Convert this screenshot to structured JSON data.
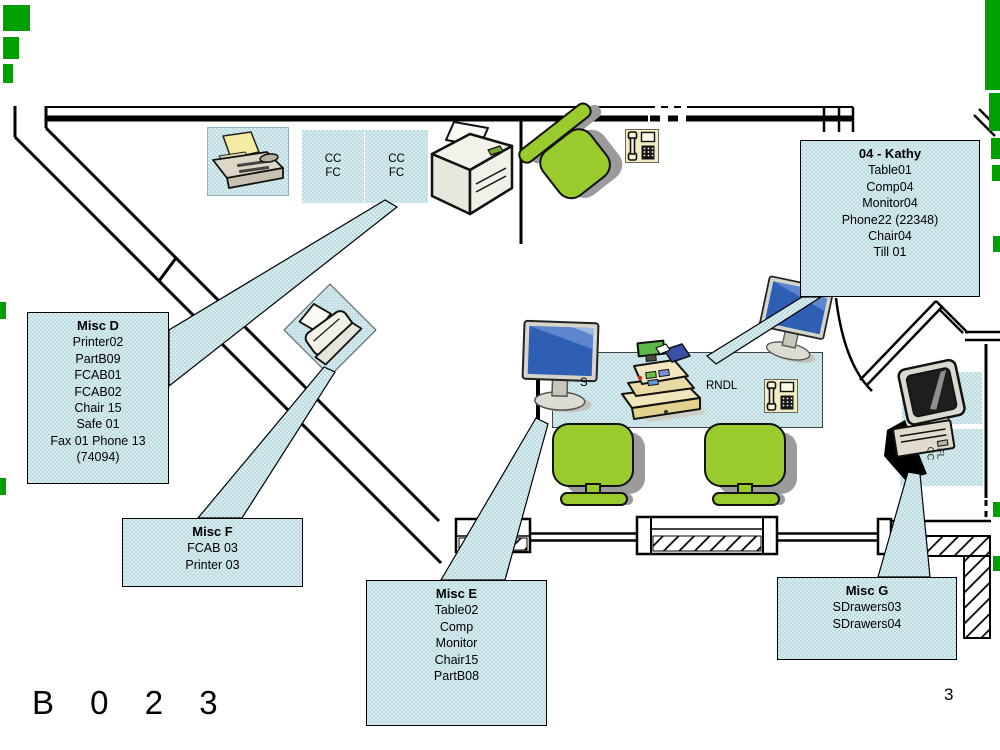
{
  "page": {
    "room_label": "B 0 2 3",
    "sheet_number": "3"
  },
  "callouts": {
    "kathy": {
      "title": "04 - Kathy",
      "lines": [
        "Table01",
        "Comp04",
        "Monitor04",
        "Phone22 (22348)",
        "Chair04",
        "Till 01"
      ]
    },
    "misc_d": {
      "title": "Misc D",
      "lines": [
        "Printer02",
        "PartB09",
        "FCAB01",
        "FCAB02",
        "Chair 15",
        "Safe 01",
        "Fax 01 Phone 13",
        "(74094)"
      ]
    },
    "misc_f": {
      "title": "Misc F",
      "lines": [
        "FCAB 03",
        "Printer 03"
      ]
    },
    "misc_e": {
      "title": "Misc E",
      "lines": [
        "Table02",
        "Comp",
        "Monitor",
        "Chair15",
        "PartB08"
      ]
    },
    "misc_g": {
      "title": "Misc G",
      "lines": [
        "SDrawers03",
        "SDrawers04"
      ]
    }
  },
  "labels": {
    "cabinet_a": {
      "line1": "CC",
      "line2": "FC"
    },
    "cabinet_b": {
      "line1": "CC",
      "line2": "FC"
    },
    "table_tag_s": "S",
    "table_tag_rndl": "RNDL",
    "floor_tag": {
      "line1": "FL",
      "line2": "CC"
    }
  },
  "icons": {
    "fax_machine": "fax-machine-icon",
    "filing_cabinet": "filing-cabinet-box",
    "laser_printer": "laser-printer-icon",
    "office_chair": "office-chair-icon",
    "telephone": "telephone-icon",
    "flat_monitor": "flat-monitor-icon",
    "cash_register": "cash-register-icon",
    "crt_computer": "crt-computer-icon",
    "small_printer": "small-printer-icon"
  },
  "colors": {
    "callout_fill": "#BCDCE2",
    "callout_checker": "#D8EBEF",
    "chair_green": "#9ACB2D",
    "shadow_gray": "#9B9B9B",
    "edge_mark_green": "#00A000",
    "screen_blue": "#2F5FB5",
    "wall_black": "#000000"
  }
}
